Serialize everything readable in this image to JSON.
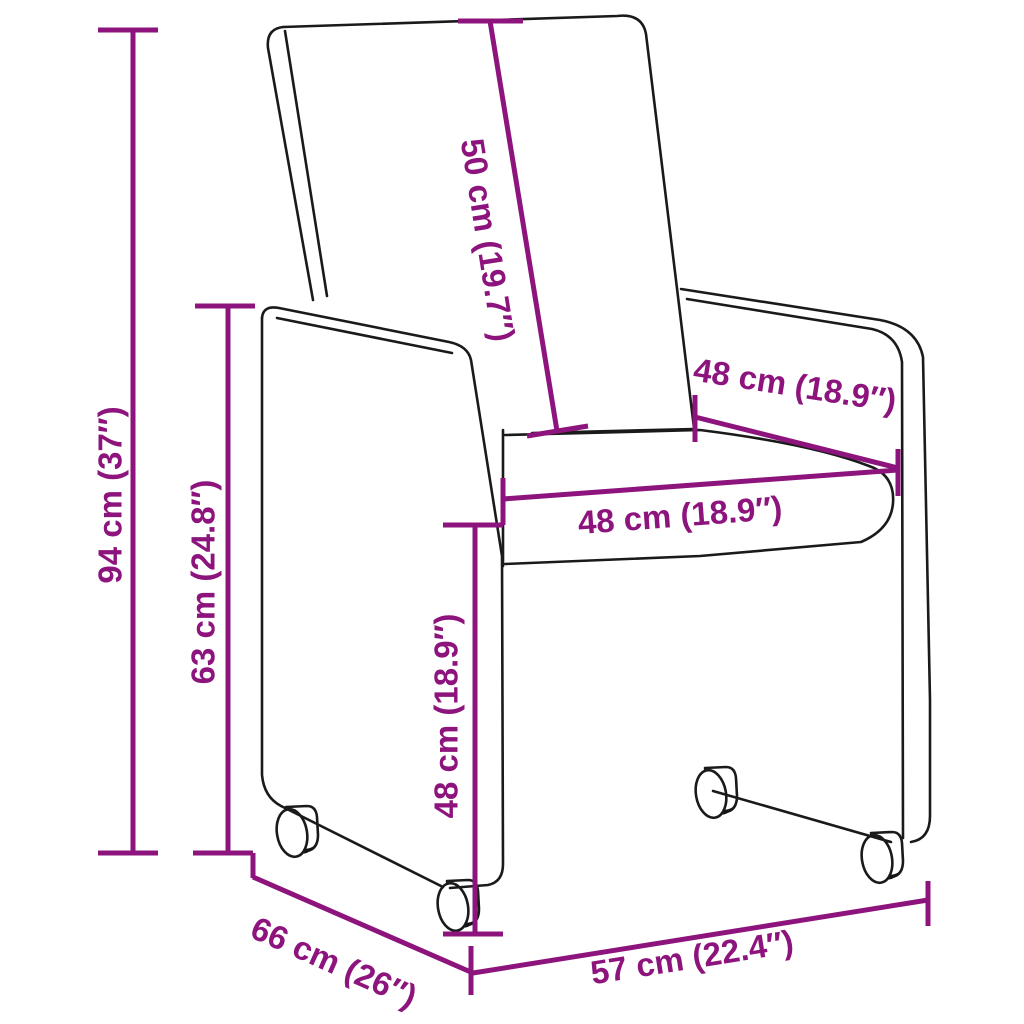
{
  "diagram": {
    "type": "product-dimension-diagram",
    "subject": "upholstered armchair with caster wheels",
    "accent_color": "#8E147D",
    "line_color": "#1a1a1a",
    "background_color": "#ffffff",
    "dimensions": [
      {
        "name": "total-height",
        "label": "94 cm (37″)"
      },
      {
        "name": "armrest-height",
        "label": "63 cm (24.8″)"
      },
      {
        "name": "backrest-height",
        "label": "50 cm (19.7″)"
      },
      {
        "name": "armrest-depth",
        "label": "48 cm (18.9″)"
      },
      {
        "name": "seat-width",
        "label": "48 cm (18.9″)"
      },
      {
        "name": "seat-height",
        "label": "48 cm (18.9″)"
      },
      {
        "name": "depth",
        "label": "66 cm (26″)"
      },
      {
        "name": "width",
        "label": "57 cm (22.4″)"
      }
    ]
  }
}
